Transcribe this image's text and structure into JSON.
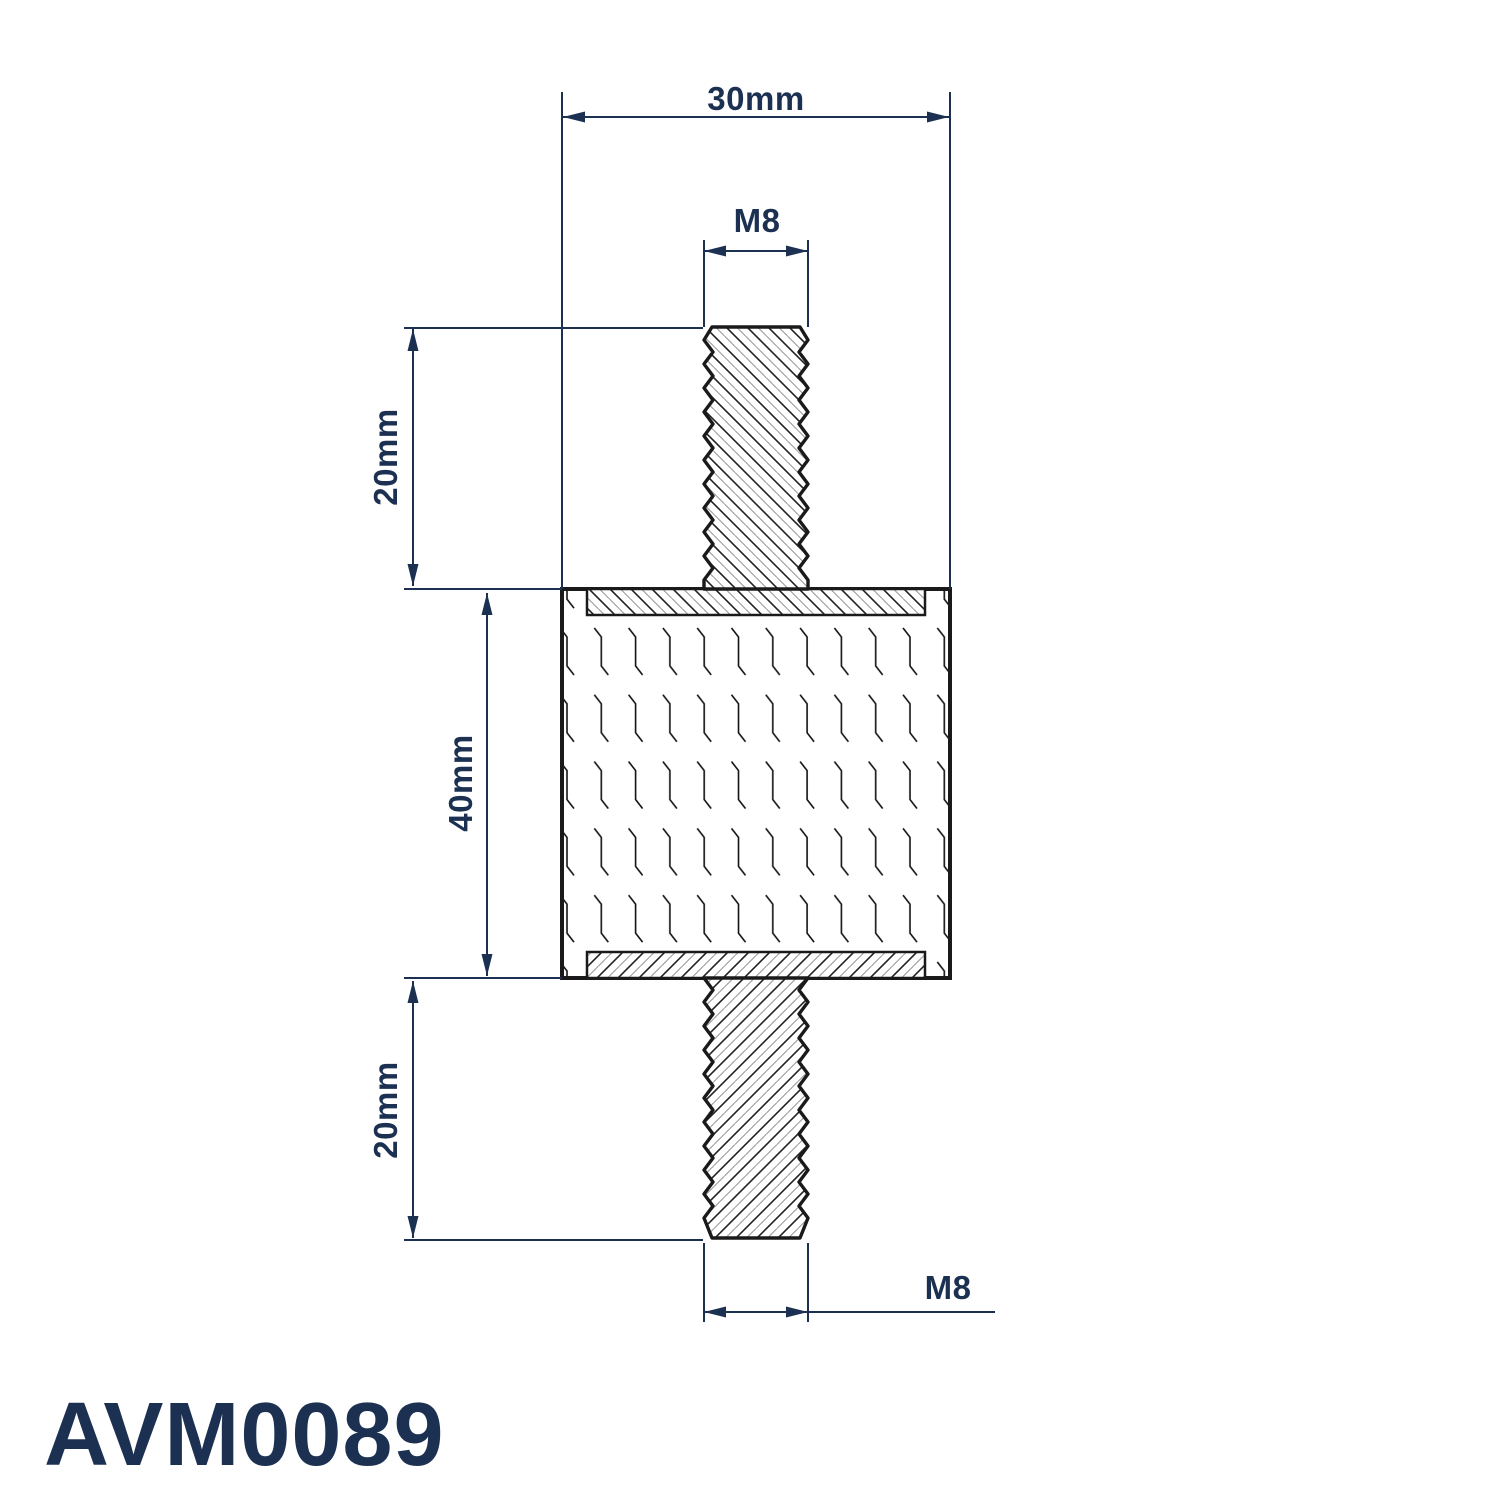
{
  "part_number": "AVM0089",
  "labels": {
    "overall_width": "30mm",
    "top_thread": "M8",
    "top_stud_length": "20mm",
    "body_height": "40mm",
    "bottom_stud_length": "20mm",
    "bottom_thread": "M8"
  },
  "colors": {
    "dimension_navy": "#1c3152",
    "outline_black": "#1a1a1a",
    "hatch_dark": "#222222",
    "hatch_gray": "#9a9a9a",
    "background": "#ffffff"
  }
}
